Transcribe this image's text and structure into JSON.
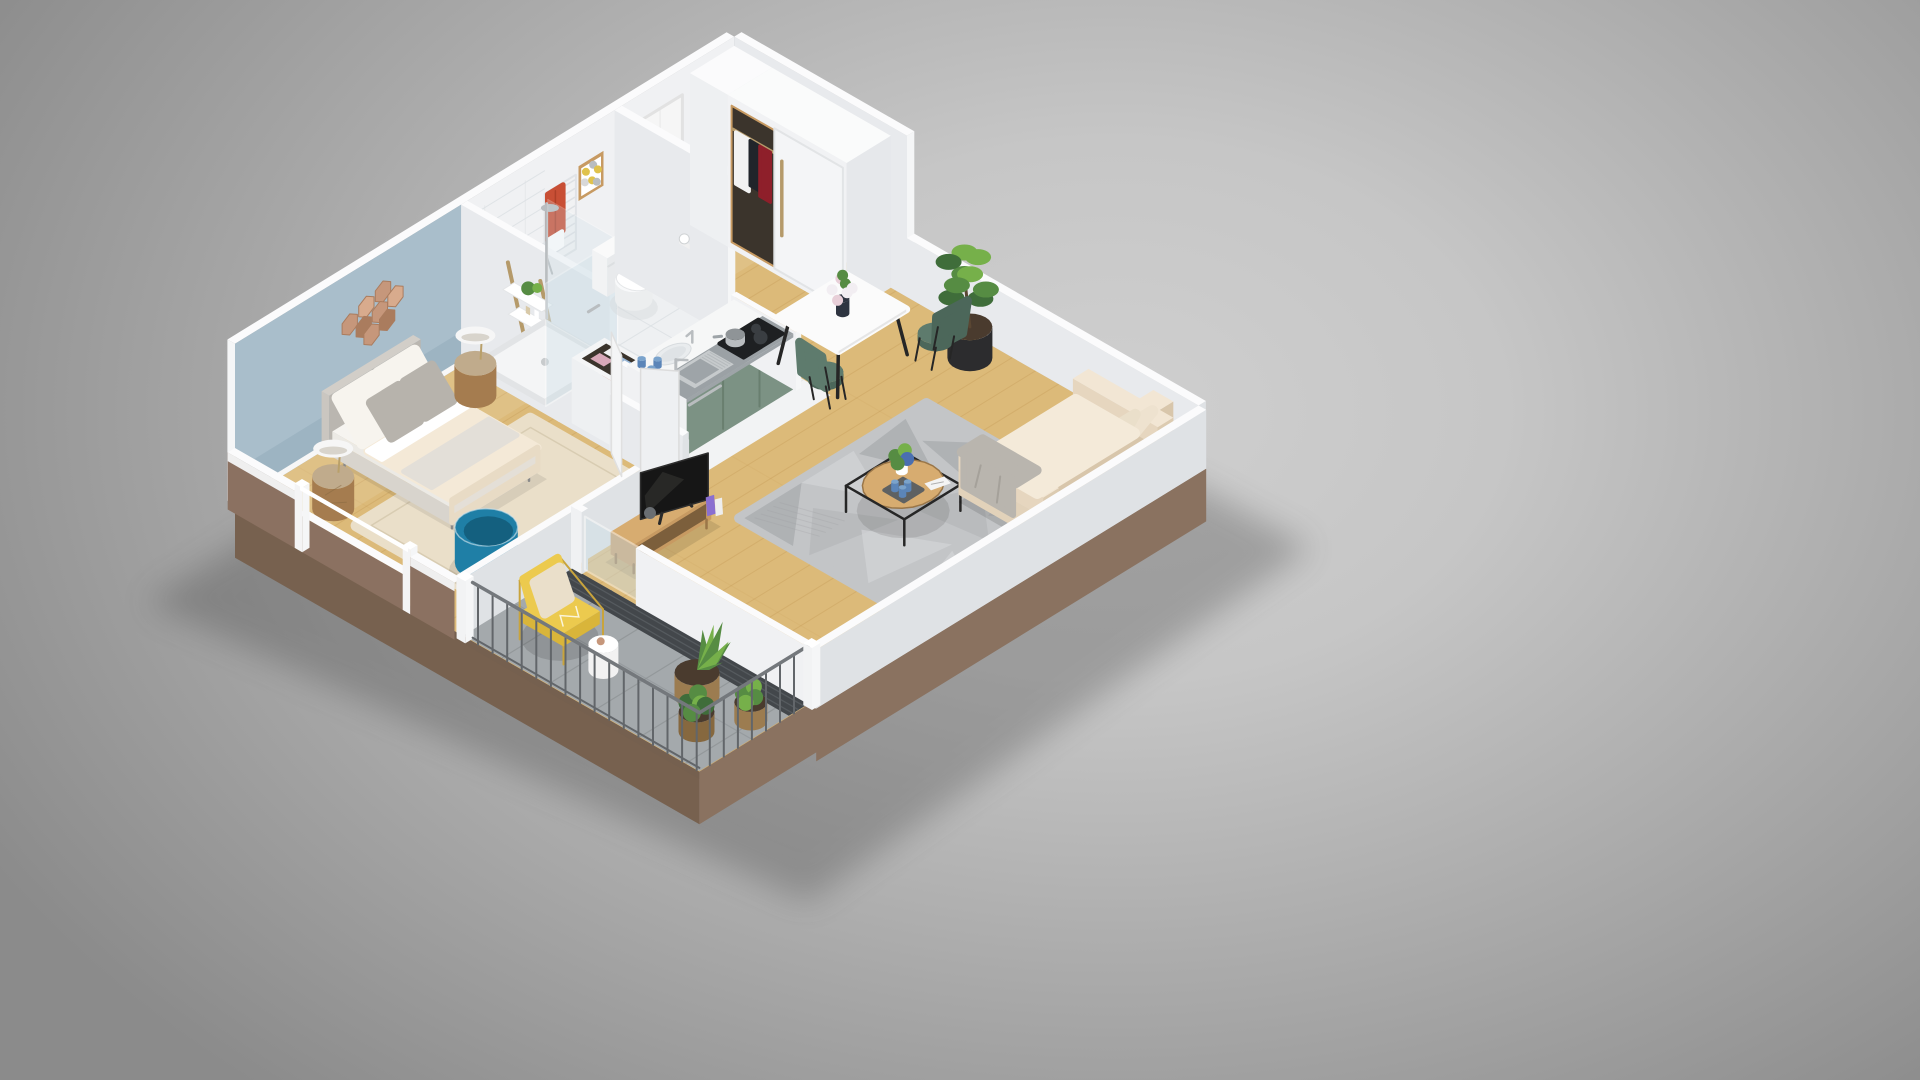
{
  "scene": {
    "type": "3d-floor-plan-render",
    "description": "Isometric cutaway 3D rendering of a furnished one-bedroom apartment with balcony on a neutral gray studio background. No text, UI chrome or labels are visible.",
    "rooms": [
      {
        "name": "bedroom",
        "furniture": [
          "double-bed",
          "upholstered-headboard",
          "white-pillows",
          "gray-pillows",
          "cream-duvet",
          "rattan-bedside-table-left",
          "rattan-bedside-table-right",
          "dome-table-lamp-left",
          "dome-table-lamp-right",
          "hexagon-copper-mirror-cluster",
          "jute-rug",
          "teal-cup-armchair",
          "window-with-white-frame",
          "blue-accent-wall",
          "open-white-doors"
        ]
      },
      {
        "name": "bathroom",
        "furniture": [
          "walk-in-shower",
          "glass-shower-screen",
          "chrome-shower-column",
          "tiled-shower-wall",
          "wooden-ladder-shelf",
          "towel-radiator",
          "red-towel",
          "red-bath-mat",
          "toilet",
          "toilet-paper-holder",
          "framed-dot-art",
          "laundry-basket-cabinet",
          "vanity-basin",
          "blue-mugs"
        ]
      },
      {
        "name": "kitchen",
        "furniture": [
          "kitchenette-unit",
          "sage-green-cabinet-fronts",
          "gray-countertop",
          "stainless-sink",
          "chrome-faucet",
          "induction-hob",
          "cooking-pot",
          "white-side-panels"
        ]
      },
      {
        "name": "entry",
        "furniture": [
          "front-door",
          "sliding-door-wardrobe",
          "hanging-clothes",
          "wood-floor"
        ]
      },
      {
        "name": "living-dining",
        "furniture": [
          "white-dining-table",
          "flower-vase",
          "green-shell-chairs",
          "potted-ficus",
          "cream-sofa",
          "coral-cushion",
          "gray-cushion",
          "white-cushion",
          "gray-throw",
          "black-frame-coffee-table",
          "round-wood-tabletop",
          "coffee-table-plant",
          "blue-cups",
          "magazine",
          "geometric-gray-rug",
          "flat-screen-tv",
          "wood-tv-bench",
          "books"
        ]
      },
      {
        "name": "balcony",
        "furniture": [
          "yellow-lounge-chair",
          "beige-pillow",
          "white-side-table",
          "wicker-planters",
          "palm-plant",
          "green-shrubs",
          "metal-railing",
          "gray-tile-floor",
          "dark-drainage-grate"
        ]
      }
    ],
    "colors": {
      "bg_center": "#cfcfcf",
      "bg_edge": "#8b8b8b",
      "shadow": "#3c3c3c",
      "slab_sw": "#77614f",
      "slab_se": "#8a7260",
      "wall_top": "#fbfbfc",
      "wall_in_light": "#f0f1f3",
      "wall_in_mid": "#e8eaed",
      "wall_in_shade": "#dfe2e5",
      "wall_end": "#f5f6f7",
      "wall_blue": "#a9becb",
      "wall_blue_shade": "#54788c",
      "ext_brown": "#8b7161",
      "ext_brown_dark": "#74604f",
      "skirting": "#f7f7f7",
      "wood": "#dcba79",
      "wood_plank": "#c49a57",
      "tile_white": "#eef0f2",
      "tile_line": "#dde1e4",
      "kitchen_floor": "#f2f3f4",
      "balcony_tile": "#a4a9ac",
      "balcony_line": "#8e9396",
      "grate": "#43474b",
      "grate_line": "#585c60",
      "rug_jute": "#eadfc9",
      "rug_jute_line": "#d8ccb2",
      "rug_gray": "#c3c5c7",
      "rug_gray_dark": "#a5a8aa",
      "rug_gray_light": "#d4d6d8",
      "green_cab": "#7c9284",
      "green_cab_dark": "#697f6f",
      "counter_gray": "#9ba1a5",
      "counter_white": "#f6f7f7",
      "steel": "#c6cacc",
      "steel_dark": "#9ea4a8",
      "hob": "#1e2022",
      "blue_mug": "#5b85b8",
      "sofa_cream": "#f1e5d3",
      "sofa_cream_dark": "#e2d2ba",
      "sofa_cream_darker": "#d8c6ab",
      "cushion_cream": "#f4ead9",
      "pillow_coral": "#d88175",
      "pillow_gray": "#b7b3ac",
      "pillow_white": "#f7f4ee",
      "pillow_beige": "#eadfca",
      "throw_gray": "#b9b5ae",
      "chair_green": "#5e7b6d",
      "chair_green_dark": "#4c675a",
      "table_white": "#fbfbfb",
      "table_edge": "#e6e6e6",
      "leg_black": "#262626",
      "wood_mid": "#c79a62",
      "wood_dark": "#9a7648",
      "wood_top": "#d7ac70",
      "tv_black": "#161616",
      "tv_screen": "#23231f",
      "teal": "#1f7fa6",
      "teal_dark": "#14607f",
      "yellow": "#ecca4e",
      "yellow_dark": "#d9b53a",
      "gold": "#c9a43c",
      "plant_dark": "#3f6d3a",
      "plant_mid": "#568c43",
      "plant_light": "#76b04a",
      "pot_black": "#2c2c2e",
      "soil": "#4a3b2e",
      "wicker": "#9c7c50",
      "wicker_dark": "#86683f",
      "copper": "#c6977b",
      "copper_light": "#d8ab8d",
      "copper_dark": "#aa7c5e",
      "red": "#c84f35",
      "white": "#ffffff",
      "lamp_white": "#f6f6f6",
      "bed_head": "#cac6c0",
      "bed_head_dark": "#bab6b0",
      "bed_frame": "#d8d4cd",
      "duvet": "#f4e9d7",
      "duvet_dark": "#e8dbc5",
      "sheet": "#ffffff",
      "throw_bed": "#e3dfd8",
      "rattan": "#a57c4f",
      "rattan_top": "#c0ab8c",
      "door": "#f6f6f6",
      "door_frame": "#e2e2e2",
      "handle": "#9aa0a6",
      "glass": "#cfe0e8",
      "chrome": "#b9bdc0",
      "radiator": "#f1f2f3",
      "radiator_line": "#dcdfe2",
      "frame_wood": "#c79a62",
      "art_yellow": "#e0c24c",
      "art_gray": "#b9bdbf",
      "dark_interior": "#3b342c",
      "cloth_white": "#f2f2f2",
      "cloth_red": "#8e1f2a",
      "cloth_black": "#20242a",
      "rail_wood": "#b59a6a",
      "magazine": "#f4f4f4",
      "tray": "#4a5560",
      "vase": "#2e3440",
      "flower_pink": "#e8cfd8",
      "flower_white": "#f2eef2",
      "book_purple": "#8a6fd0",
      "book_white": "#eeeeee",
      "railing": "#62666a",
      "railing_top": "#74787c"
    }
  }
}
